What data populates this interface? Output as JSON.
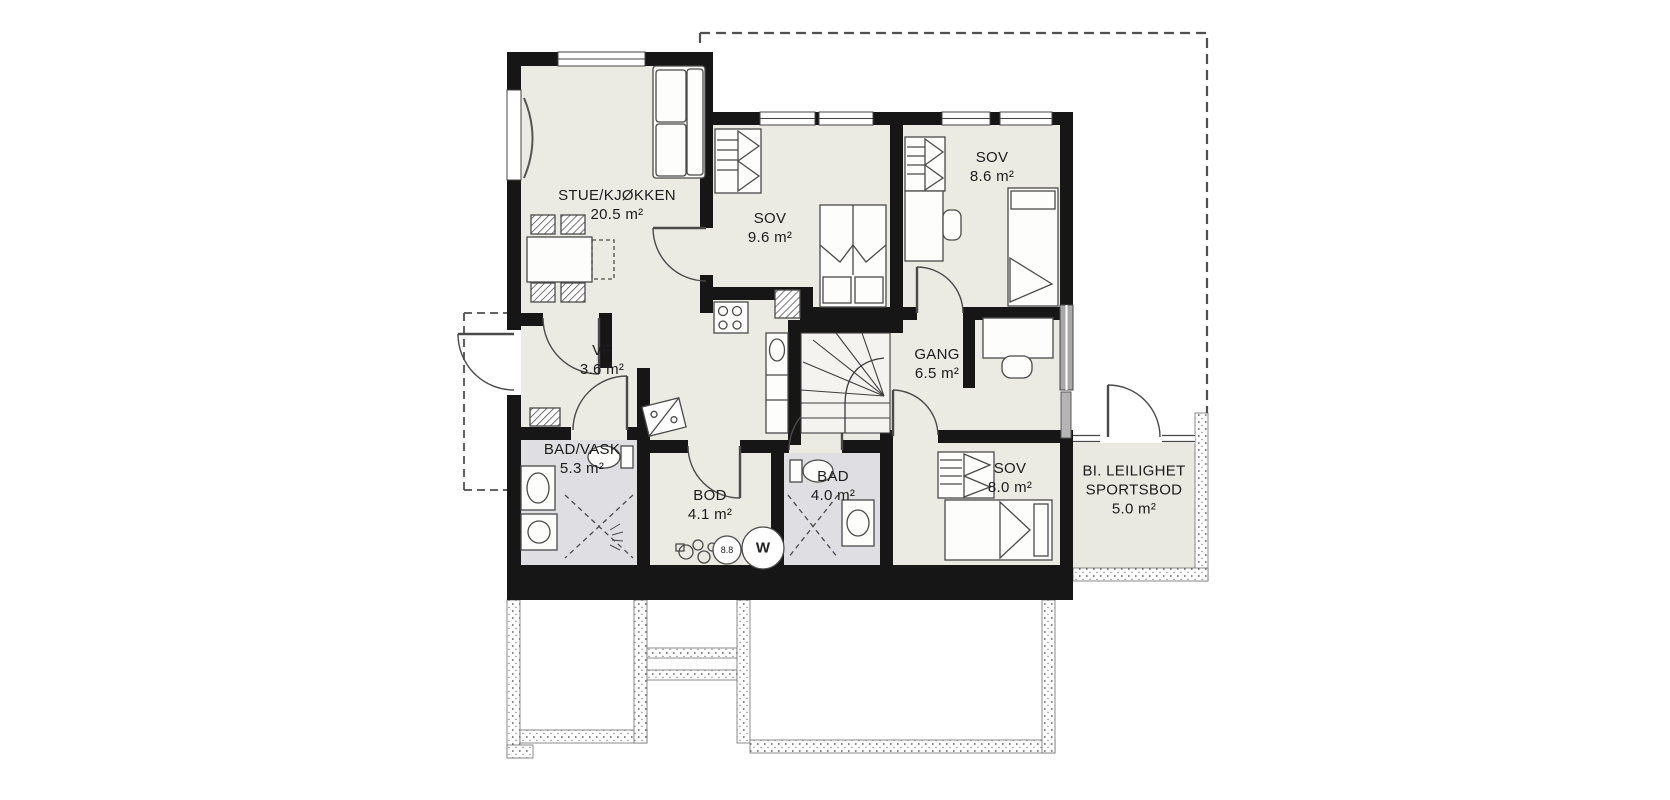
{
  "plan": {
    "title": "floor plan",
    "rooms": [
      {
        "id": "stue",
        "name": "STUE/KJØKKEN",
        "area": "20.5 m²"
      },
      {
        "id": "sov-1",
        "name": "SOV",
        "area": "9.6 m²"
      },
      {
        "id": "sov-2",
        "name": "SOV",
        "area": "8.6 m²"
      },
      {
        "id": "vf",
        "name": "VF",
        "area": "3.6 m²"
      },
      {
        "id": "gang",
        "name": "GANG",
        "area": "6.5 m²"
      },
      {
        "id": "bad-vask",
        "name": "BAD/VASK",
        "area": "5.3 m²"
      },
      {
        "id": "bod",
        "name": "BOD",
        "area": "4.1 m²"
      },
      {
        "id": "bad",
        "name": "BAD",
        "area": "4.0 m²"
      },
      {
        "id": "sov-3",
        "name": "SOV",
        "area": "8.0 m²"
      },
      {
        "id": "sportsbod",
        "name_line1": "BI. LEILIGHET",
        "name_line2": "SPORTSBOD",
        "area": "5.0 m²"
      }
    ],
    "markers": {
      "fuse_circle": "8.8",
      "water_heater": "W"
    },
    "colors": {
      "wall": "#161616",
      "floor": "#ebeae3",
      "wet_floor": "#dfdfe3",
      "annex_floor": "#e9e8e1",
      "stair_floor": "#f4f3ef",
      "furniture_line": "#4a4a4a"
    }
  }
}
